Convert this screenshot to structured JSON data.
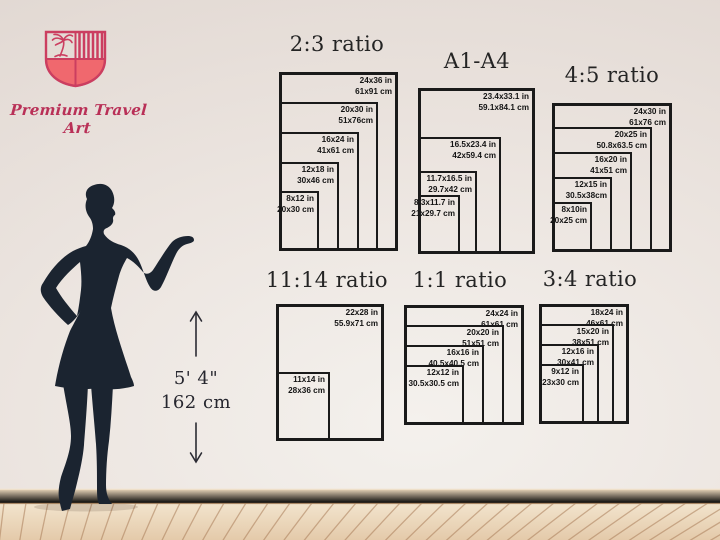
{
  "logo": {
    "brand": "Premium Travel Art"
  },
  "measurement": {
    "imperial": "5' 4\"",
    "metric": "162 cm"
  },
  "charts": [
    {
      "title": "2:3 ratio",
      "sizes": [
        {
          "w": 24,
          "h": 36,
          "in": "24x36 in",
          "cm": "61x91 cm"
        },
        {
          "w": 20,
          "h": 30,
          "in": "20x30 in",
          "cm": "51x76cm"
        },
        {
          "w": 16,
          "h": 24,
          "in": "16x24 in",
          "cm": "41x61 cm"
        },
        {
          "w": 12,
          "h": 18,
          "in": "12x18 in",
          "cm": "30x46 cm"
        },
        {
          "w": 8,
          "h": 12,
          "in": "8x12 in",
          "cm": "20x30 cm"
        }
      ]
    },
    {
      "title": "A1-A4",
      "sizes": [
        {
          "w": 23.4,
          "h": 33.1,
          "in": "23.4x33.1 in",
          "cm": "59.1x84.1 cm"
        },
        {
          "w": 16.5,
          "h": 23.4,
          "in": "16.5x23.4 in",
          "cm": "42x59.4 cm"
        },
        {
          "w": 11.7,
          "h": 16.5,
          "in": "11.7x16.5 in",
          "cm": "29.7x42 cm"
        },
        {
          "w": 8.3,
          "h": 11.7,
          "in": "8.3x11.7 in",
          "cm": "21x29.7 cm"
        }
      ]
    },
    {
      "title": "4:5 ratio",
      "sizes": [
        {
          "w": 24,
          "h": 30,
          "in": "24x30 in",
          "cm": "61x76 cm"
        },
        {
          "w": 20,
          "h": 25,
          "in": "20x25 in",
          "cm": "50.8x63.5 cm"
        },
        {
          "w": 16,
          "h": 20,
          "in": "16x20 in",
          "cm": "41x51 cm"
        },
        {
          "w": 12,
          "h": 15,
          "in": "12x15 in",
          "cm": "30.5x38cm"
        },
        {
          "w": 8,
          "h": 10,
          "in": "8x10in",
          "cm": "20x25 cm"
        }
      ]
    },
    {
      "title": "11:14 ratio",
      "sizes": [
        {
          "w": 22,
          "h": 28,
          "in": "22x28 in",
          "cm": "55.9x71 cm"
        },
        {
          "w": 11,
          "h": 14,
          "in": "11x14 in",
          "cm": "28x36 cm"
        }
      ]
    },
    {
      "title": "1:1 ratio",
      "sizes": [
        {
          "w": 24,
          "h": 24,
          "in": "24x24 in",
          "cm": "61x61 cm"
        },
        {
          "w": 20,
          "h": 20,
          "in": "20x20 in",
          "cm": "51x51 cm"
        },
        {
          "w": 16,
          "h": 16,
          "in": "16x16 in",
          "cm": "40.5x40.5 cm"
        },
        {
          "w": 12,
          "h": 12,
          "in": "12x12 in",
          "cm": "30.5x30.5 cm"
        }
      ]
    },
    {
      "title": "3:4 ratio",
      "sizes": [
        {
          "w": 18,
          "h": 24,
          "in": "18x24 in",
          "cm": "46x61 cm"
        },
        {
          "w": 15,
          "h": 20,
          "in": "15x20 in",
          "cm": "38x51 cm"
        },
        {
          "w": 12,
          "h": 16,
          "in": "12x16 in",
          "cm": "30x41 cm"
        },
        {
          "w": 9,
          "h": 12,
          "in": "9x12 in",
          "cm": "23x30 cm"
        }
      ]
    }
  ],
  "colors": {
    "accent": "#cb3e60",
    "silhouette": "#1b2430",
    "frame": "#1a1a1a",
    "floor": "#e8d2b6",
    "wall": "#ece5e0"
  }
}
